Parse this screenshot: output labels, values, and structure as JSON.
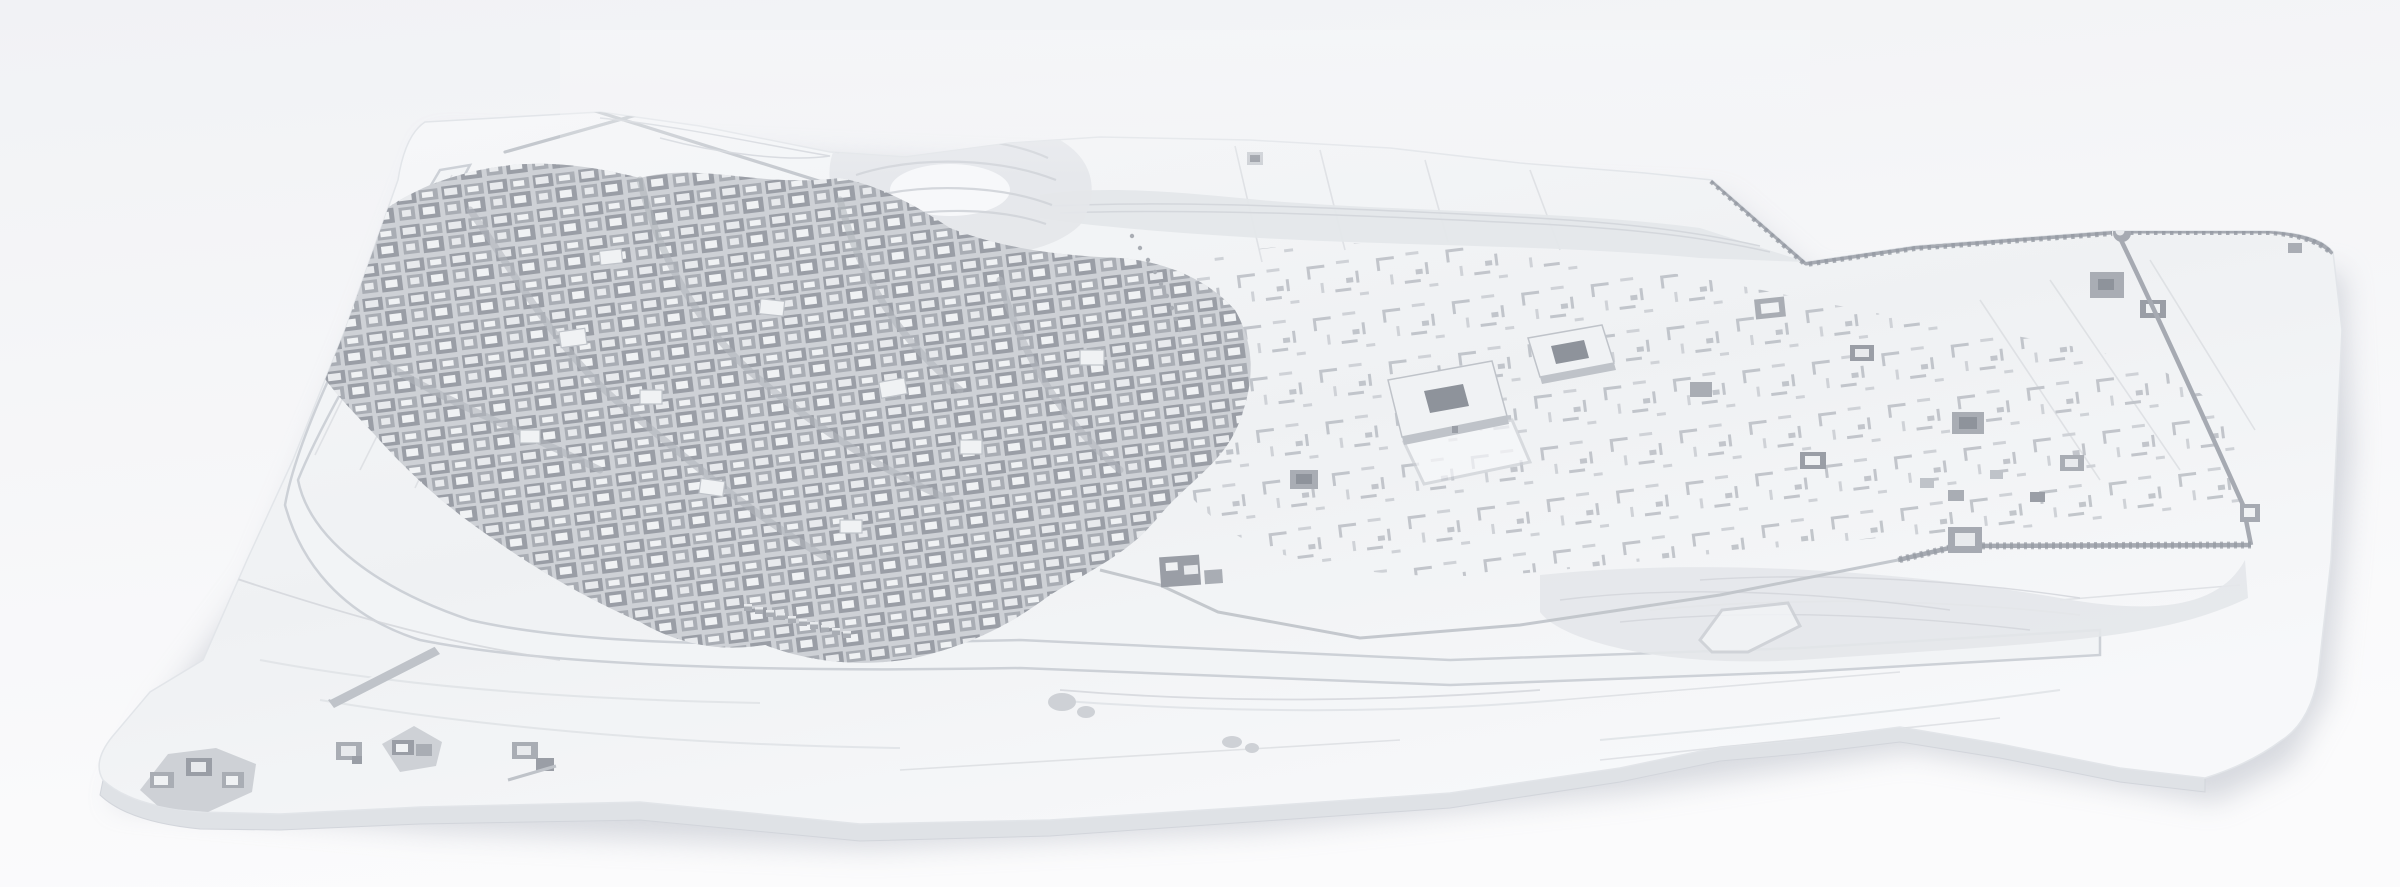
{
  "scene": {
    "description": "Monochrome 3D architectural reconstruction model of a historic walled oasis city, viewed from a high oblique aerial angle. A dense old town of courtyard houses sits on the left half of a rounded, thick base slab; a crenellated fortification wall with corner towers encloses a sparser field of ruins on the right; two large rectangular caravanserai buildings with open courtyards stand in the center; a terraced citadel mound rises at the top; a river channel with levees, a pier bridge and a causeway crosses the floodplain along the bottom; small outlying farm compounds dot the lower-left corner.",
    "render_style": "white clay / ambient-occlusion render, no textures, no text",
    "view": "bird's-eye perspective, light from upper left",
    "features": [
      "base-slab",
      "slab-side-face",
      "slab-shadow",
      "old-town-district",
      "street-network",
      "monument-roofs",
      "citadel-mound",
      "escarpment",
      "badlands",
      "city-wall-north",
      "city-wall-east",
      "city-wall-south",
      "levee-wall",
      "cone-tower",
      "corner-round-tower",
      "gate-tower-west",
      "gate-tower-east",
      "caravanserai-a",
      "caravanserai-b",
      "walled-yard",
      "square-compound",
      "ruins-field",
      "ruin-compounds",
      "column-base-trail",
      "cistern-pit",
      "river-channel",
      "braided-channels",
      "bridge-piers",
      "causeway",
      "river-gate-complex",
      "field-boundary-lines",
      "field-walls",
      "outlying-compound-1",
      "outlying-compound-2",
      "outlying-compound-3",
      "outlying-compound-4",
      "livestock-pen",
      "rock-outcrops"
    ]
  },
  "colors": {
    "bg_top": "#f1f2f5",
    "bg_bottom": "#fbfbfc",
    "fog": "#f5f6f8",
    "shadow": "#b3b8c2",
    "slab_light": "#f7f8fa",
    "slab": "#eff1f3",
    "slab_edge": "#e2e5e9",
    "slab_side": "#dfe2e6",
    "slab_side_dark": "#d2d5db",
    "terrain": "#e4e7ea",
    "terrain_line": "#d2d5da",
    "field_line": "#d8dbdf",
    "river_fill": "#f2f4f6",
    "river_bank": "#cdd1d7",
    "channel_line": "#e0e3e7",
    "city_base": "#ced1d6",
    "street": "#b0b4bb",
    "wall": "#a9adb4",
    "wall_dark": "#9a9ea6",
    "roof": "#e8eaed",
    "roof_bright": "#f0f2f4",
    "courtyard": "#8e939b",
    "ruin": "#bfc3c9",
    "ruin_light": "#cdd0d5",
    "fort_wall": "#a6aab2",
    "crenel": "#959aa2",
    "highlight": "#eef0f2",
    "grain": "#9aa0a8"
  }
}
